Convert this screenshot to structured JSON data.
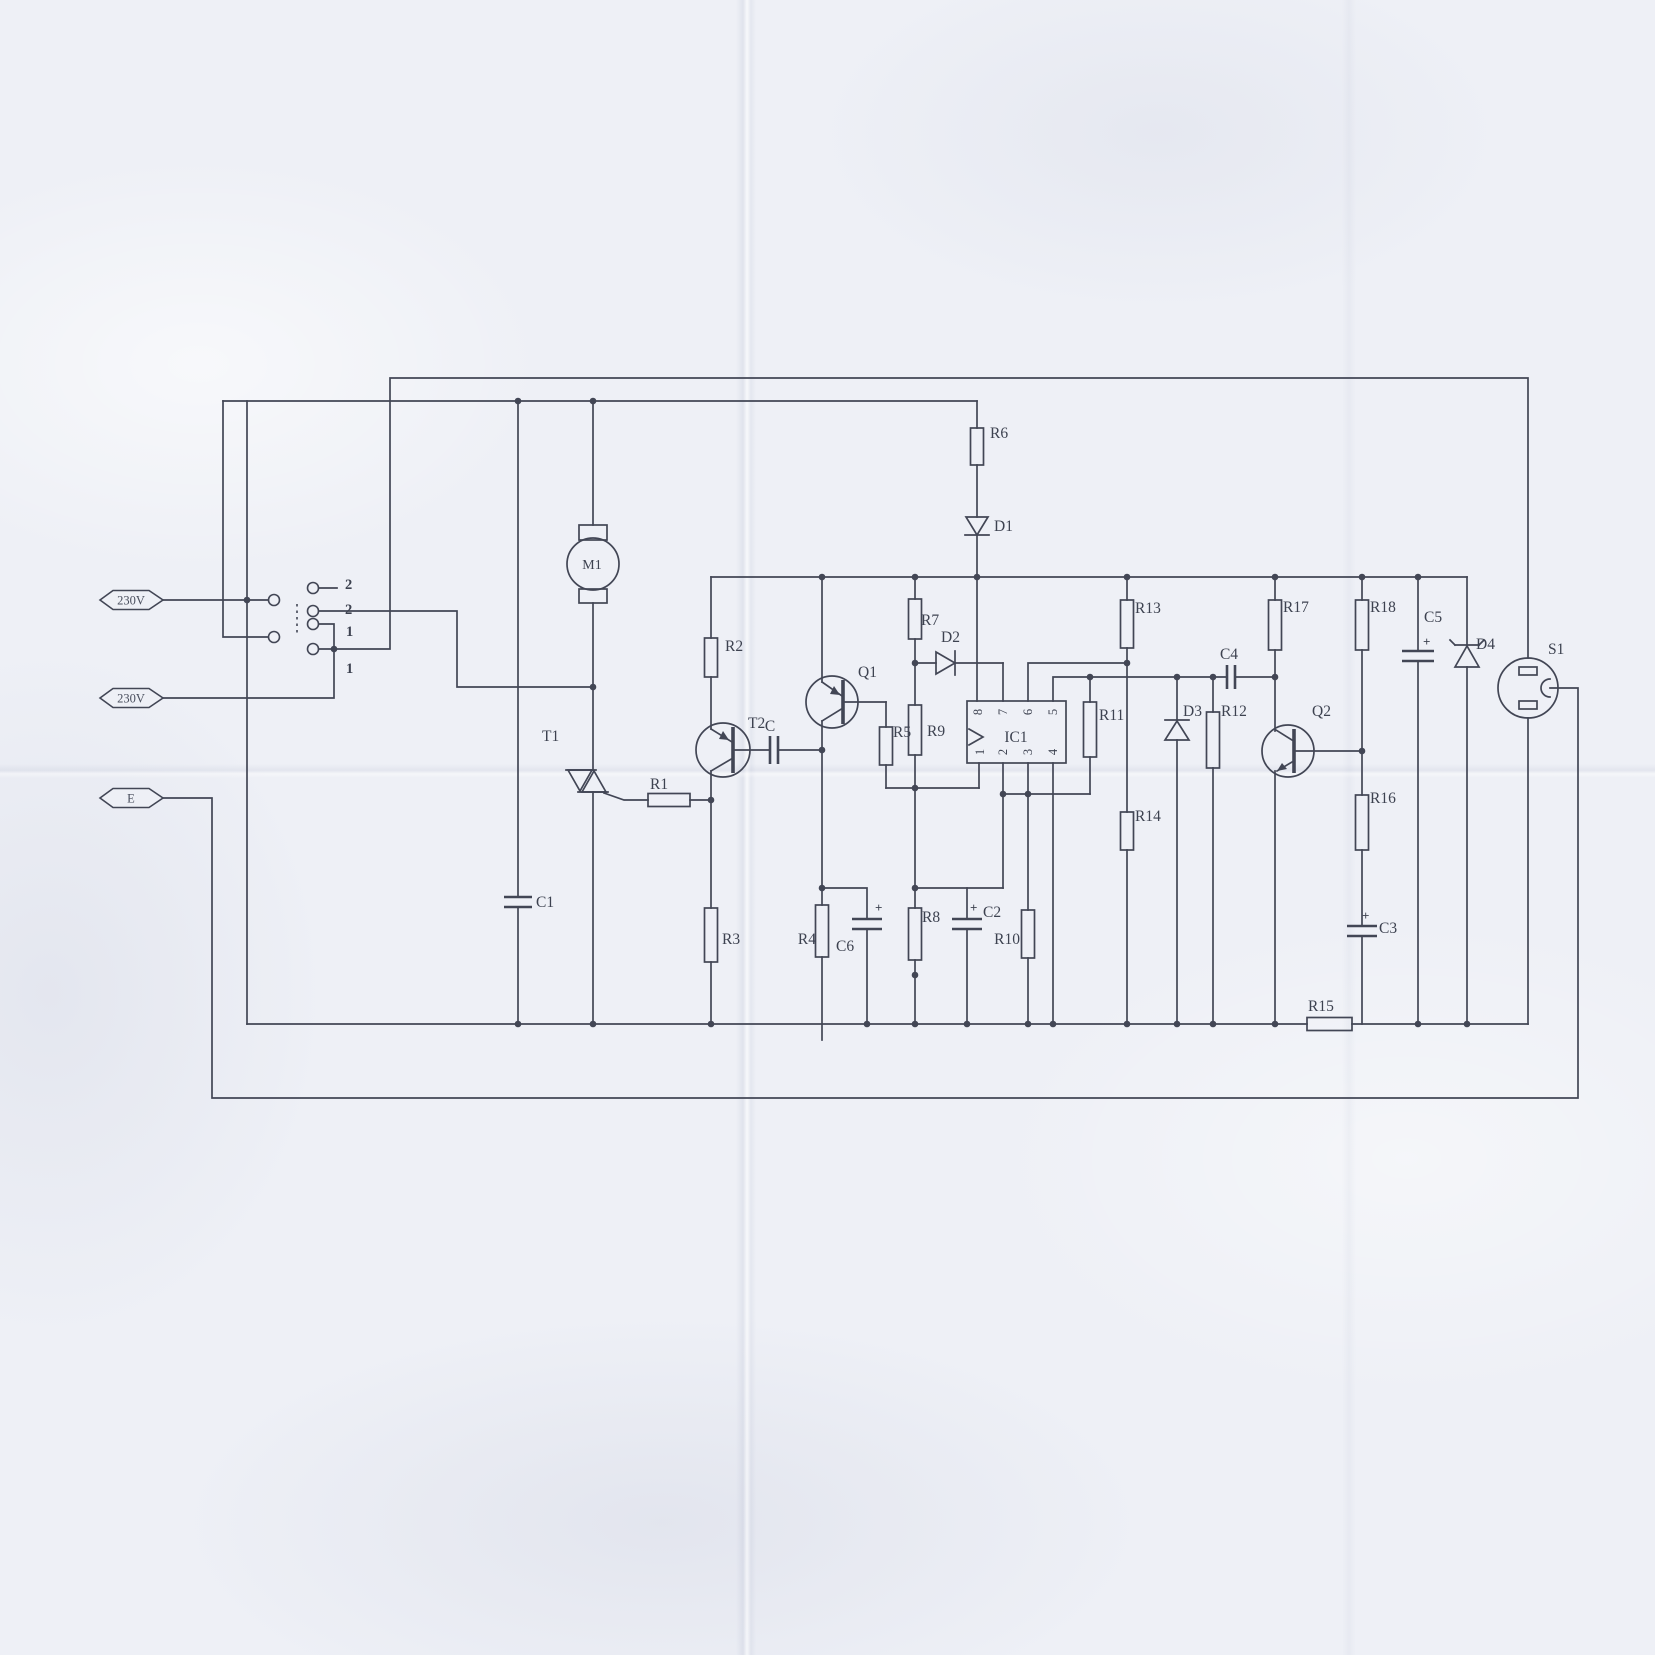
{
  "schematic": {
    "terminals": {
      "line1": "230V",
      "line2": "230V",
      "earth": "E"
    },
    "selector": {
      "positions": [
        "2",
        "2",
        "1",
        "1"
      ]
    },
    "parts": {
      "m1": "M1",
      "t1": "T1",
      "t2": "T2",
      "q1": "Q1",
      "q2": "Q2",
      "ic1": "IC1",
      "s1": "S1",
      "r1": "R1",
      "r2": "R2",
      "r3": "R3",
      "r4": "R4",
      "r5": "R5",
      "r6": "R6",
      "r7": "R7",
      "r8": "R8",
      "r9": "R9",
      "r10": "R10",
      "r11": "R11",
      "r12": "R12",
      "r13": "R13",
      "r14": "R14",
      "r15": "R15",
      "r16": "R16",
      "r17": "R17",
      "r18": "R18",
      "c": "C",
      "c1": "C1",
      "c2": "C2",
      "c3": "C3",
      "c4": "C4",
      "c5": "C5",
      "c6": "C6",
      "d1": "D1",
      "d2": "D2",
      "d3": "D3",
      "d4": "D4",
      "plus": "+"
    },
    "ic_pins": [
      "1",
      "2",
      "3",
      "4",
      "5",
      "6",
      "7",
      "8"
    ],
    "colors": {
      "ink": "#424655",
      "paper": "#eef0f6"
    }
  }
}
